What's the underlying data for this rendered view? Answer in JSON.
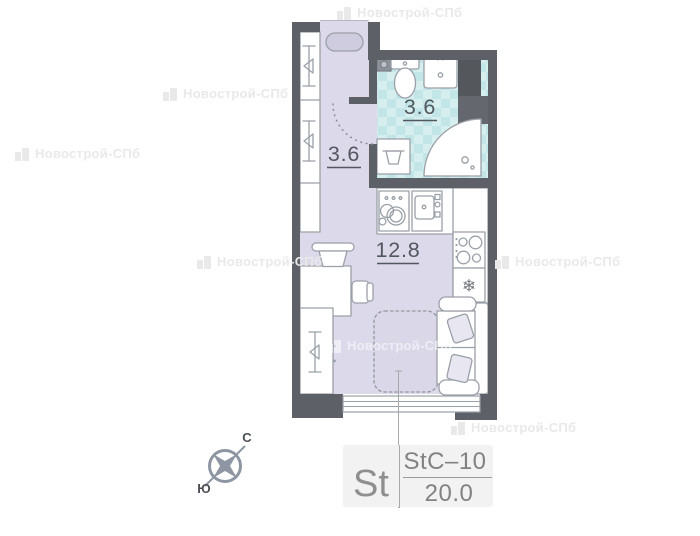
{
  "watermark": {
    "text": "Новострой-СПб"
  },
  "plan": {
    "rooms": [
      {
        "id": "hallway",
        "area": "3.6"
      },
      {
        "id": "bathroom",
        "area": "3.6"
      },
      {
        "id": "living-room",
        "area": "12.8"
      }
    ]
  },
  "compass": {
    "north_label": "С",
    "south_label": "Ю"
  },
  "info_block": {
    "type_short": "St",
    "plan_code": "StC–10",
    "total_area": "20.0"
  },
  "icons": {
    "snowflake": "❄"
  },
  "colors": {
    "wall": "#5d6167",
    "floor": "#dcd9ea",
    "bathroom_tile_light": "#d6eeee",
    "bathroom_tile_dark": "#c2e6e7",
    "fixture_outline": "#9aa0a8",
    "label_text": "#53575f",
    "info_text": "#8a8a8a",
    "compass": "#8d96a2"
  }
}
